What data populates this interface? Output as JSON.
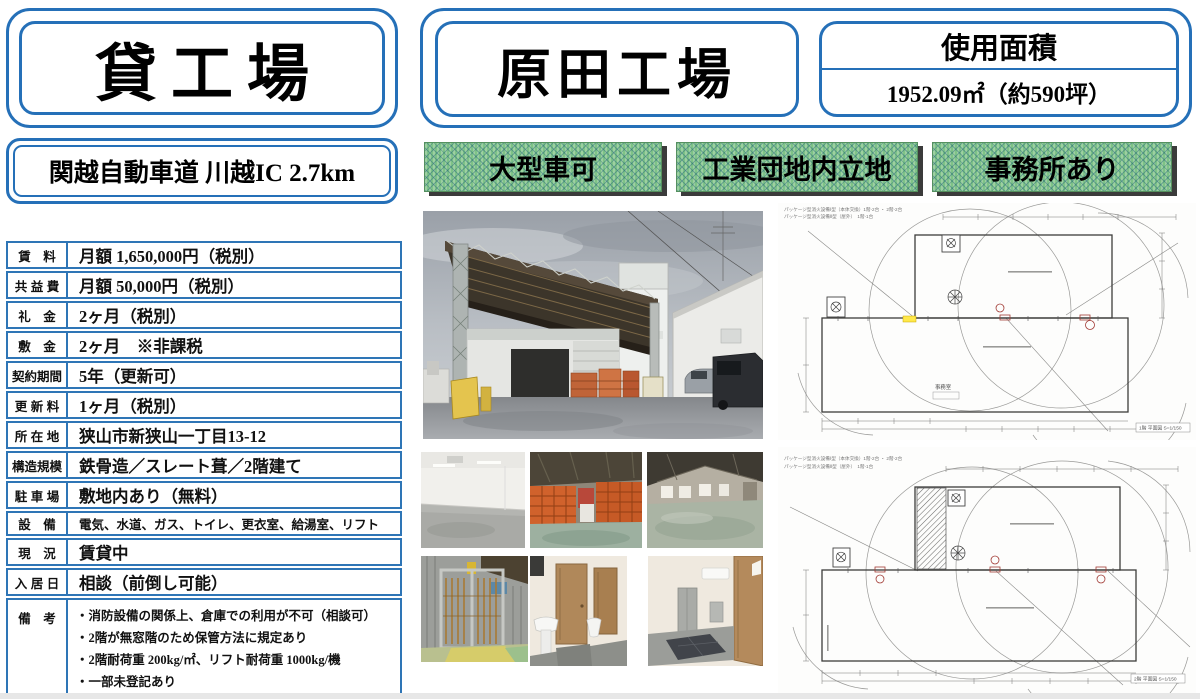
{
  "header": {
    "property_type": "貸工場",
    "access": "関越自動車道 川越IC 2.7km",
    "property_name": "原田工場",
    "area_label": "使用面積",
    "area_value": "1952.09㎡（約590坪）",
    "badges": [
      {
        "label": "大型車可"
      },
      {
        "label": "工業団地内立地"
      },
      {
        "label": "事務所あり"
      }
    ],
    "colors": {
      "accent_blue": "#2570b8",
      "badge_green": "#84c489",
      "badge_shadow": "#3b3b3b"
    }
  },
  "details": {
    "rows": [
      {
        "label": "賃　料",
        "value": "月額 1,650,000円（税別）"
      },
      {
        "label": "共 益 費",
        "value": "月額 50,000円（税別）"
      },
      {
        "label": "礼　金",
        "value": "2ヶ月（税別）"
      },
      {
        "label": "敷　金",
        "value": "2ヶ月　※非課税"
      },
      {
        "label": "契約期間",
        "value": "5年（更新可）"
      },
      {
        "label": "更 新 料",
        "value": "1ヶ月（税別）"
      },
      {
        "label": "所 在 地",
        "value": "狭山市新狭山一丁目13-12"
      },
      {
        "label": "構造規模",
        "value": "鉄骨造／スレート葺／2階建て"
      },
      {
        "label": "駐 車 場",
        "value": "敷地内あり（無料）"
      },
      {
        "label": "設　備",
        "value": "電気、水道、ガス、トイレ、更衣室、給湯室、リフト"
      },
      {
        "label": "現　況",
        "value": "賃貸中"
      },
      {
        "label": "入 居 日",
        "value": "相談（前倒し可能）"
      }
    ],
    "remarks": {
      "label": "備　考",
      "items": [
        "・消防設備の関係上、倉庫での利用が不可（相談可）",
        "・2階が無窓階のため保管方法に規定あり",
        "・2階耐荷重 200kg/㎡、リフト耐荷重 1000kg/機",
        "・一部未登記あり",
        "・賃貸保証会社（Casa）利用必須"
      ]
    }
  },
  "photos": {
    "main": "exterior-canopy-yard",
    "thumbs": [
      "white-room-interior",
      "warehouse-orange-crates",
      "warehouse-truss-interior",
      "freight-lift-gate",
      "washroom-doors-sink",
      "hallway-ac-lockers"
    ]
  },
  "floorplans": {
    "plan1": {
      "caption1": "パッケージ型消火設備Ⅰ型（本体交換）1階-2台 ・ 2階-2台",
      "caption2": "パッケージ型消火設備Ⅱ型（屋外）　1階-1台",
      "room_label": "事務室",
      "title": "1階 平面図 S=1/150"
    },
    "plan2": {
      "caption1": "パッケージ型消火設備Ⅰ型（本体交換）1階-2台 ・ 2階-2台",
      "caption2": "パッケージ型消火設備Ⅱ型（屋外）　1階-1台",
      "title": "2階 平面図 S=1/150"
    }
  }
}
